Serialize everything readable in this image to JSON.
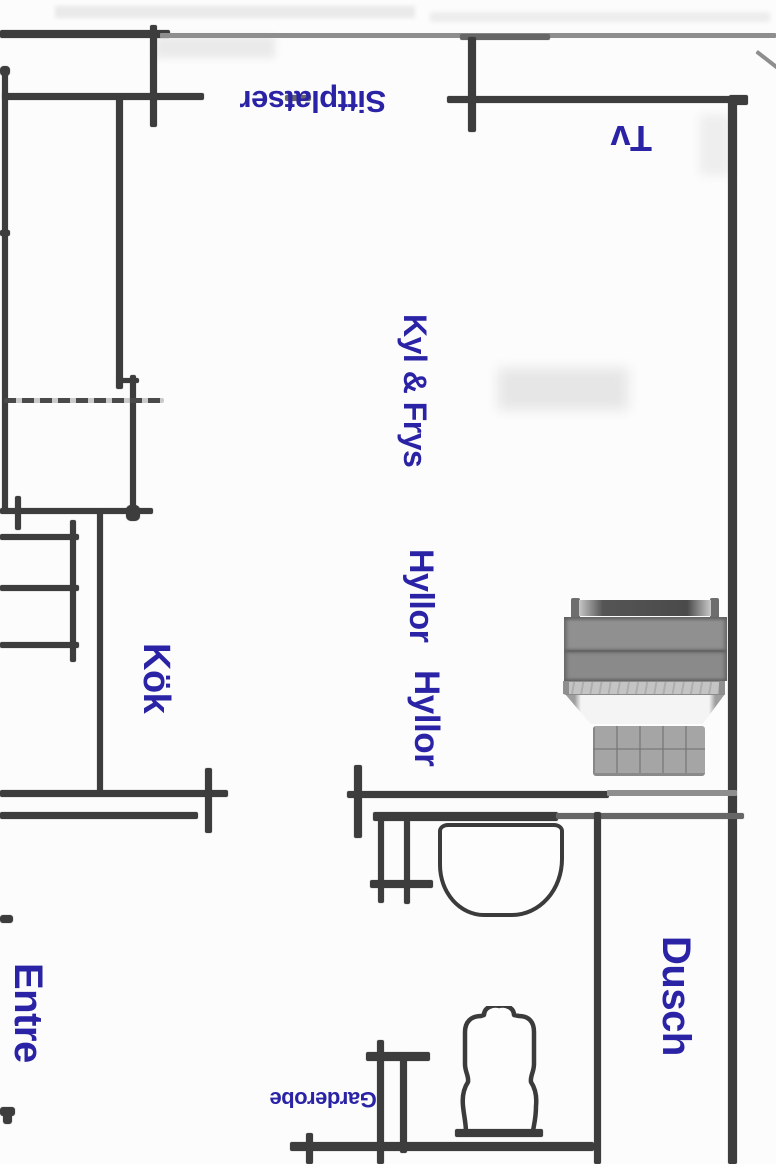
{
  "document": {
    "type": "scanned floor plan",
    "language": "Swedish"
  },
  "labels": {
    "sittplatser": "Sittplatser",
    "tv": "Tv",
    "kyl_frys": "Kyl & Frys",
    "hyllor_1": "Hyllor",
    "hyllor_2": "Hyllor",
    "kok": "Kök",
    "entre": "Entre",
    "dusch": "Dusch",
    "garderobe": "Garderobe"
  },
  "colors": {
    "label_blue": "#2a23a5",
    "wall_dark": "#3d3d3d",
    "wall_medium": "#666666",
    "wall_gray": "#8e8e8e",
    "paper": "#fcfcfc"
  },
  "furniture": {
    "bed": "double-bed-top-view",
    "sink": "washbasin-top-view",
    "toilet": "toilet-top-view"
  }
}
